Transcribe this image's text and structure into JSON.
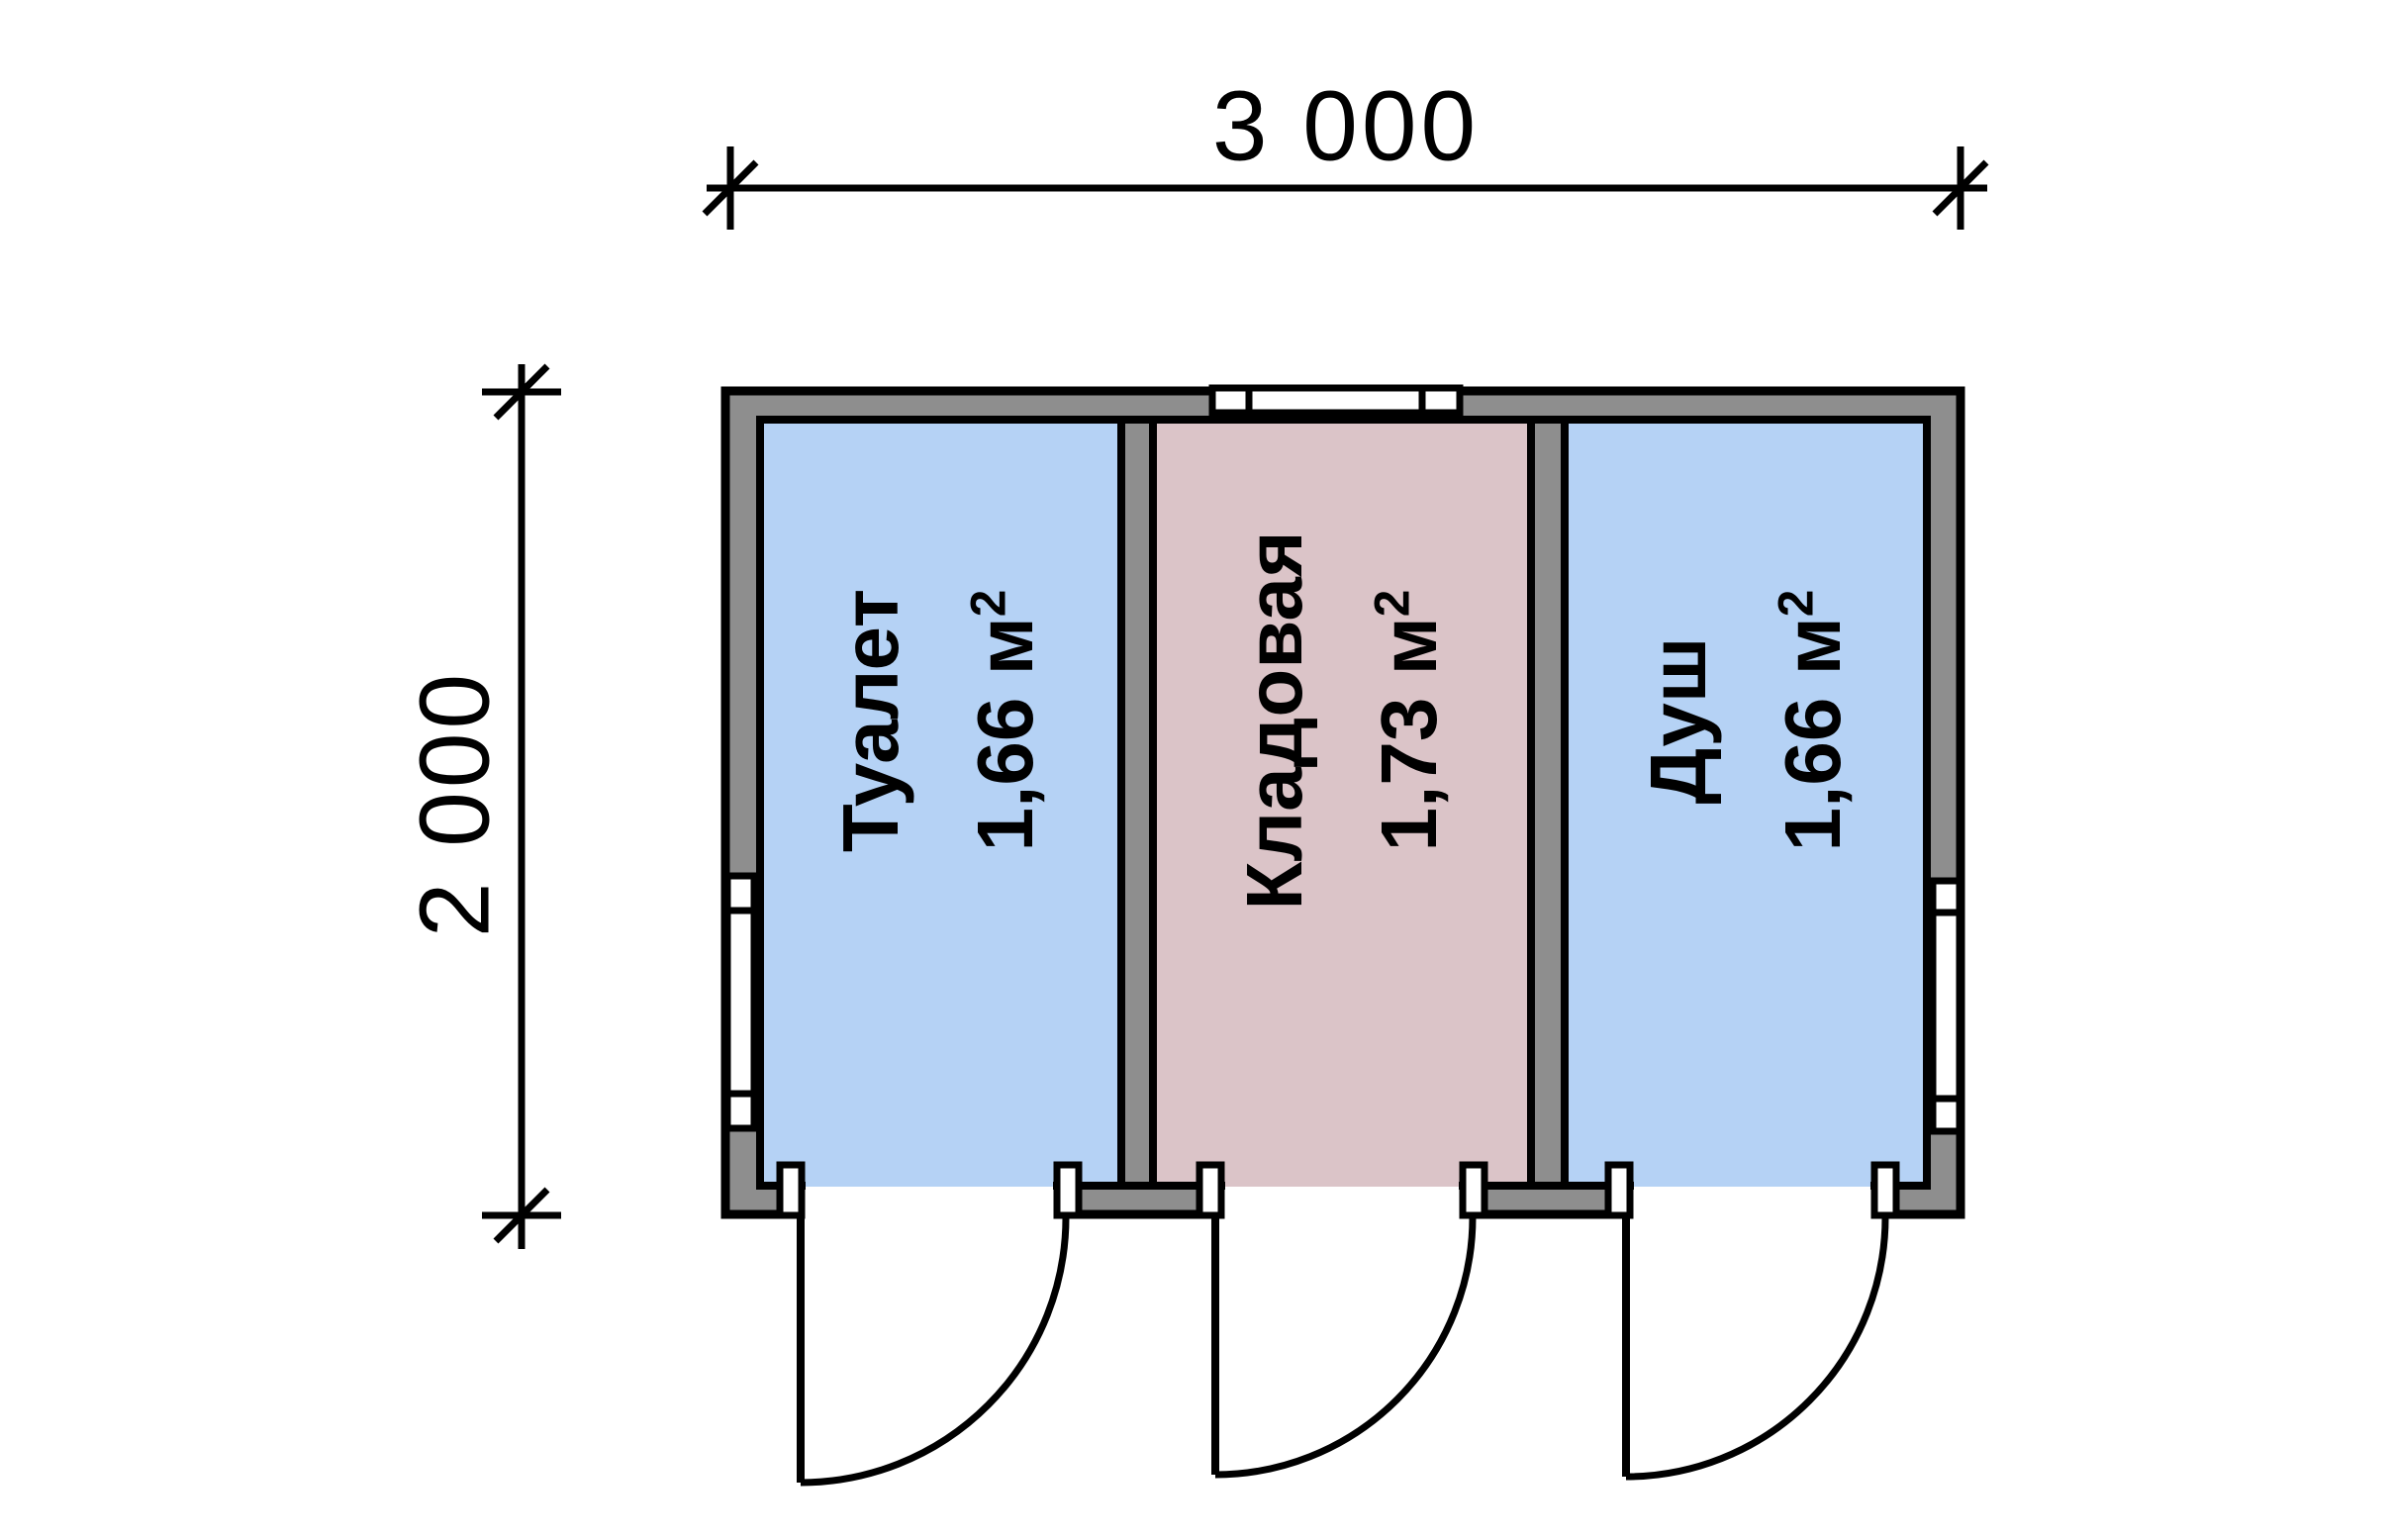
{
  "diagram": {
    "background": "#ffffff",
    "dimensions": {
      "width_label": "3 000",
      "height_label": "2 000"
    },
    "rooms": [
      {
        "name": "Туалет",
        "area": "1,66 м",
        "area_sup": "2",
        "fill": "#b5d2f5"
      },
      {
        "name": "Кладовая",
        "area": "1,73 м",
        "area_sup": "2",
        "fill": "#dbc4c8"
      },
      {
        "name": "Душ",
        "area": "1,66 м",
        "area_sup": "2",
        "fill": "#b5d2f5"
      }
    ],
    "colors": {
      "wall_fill": "#8e8e8e",
      "line": "#000000",
      "window_fill": "#ffffff"
    }
  }
}
